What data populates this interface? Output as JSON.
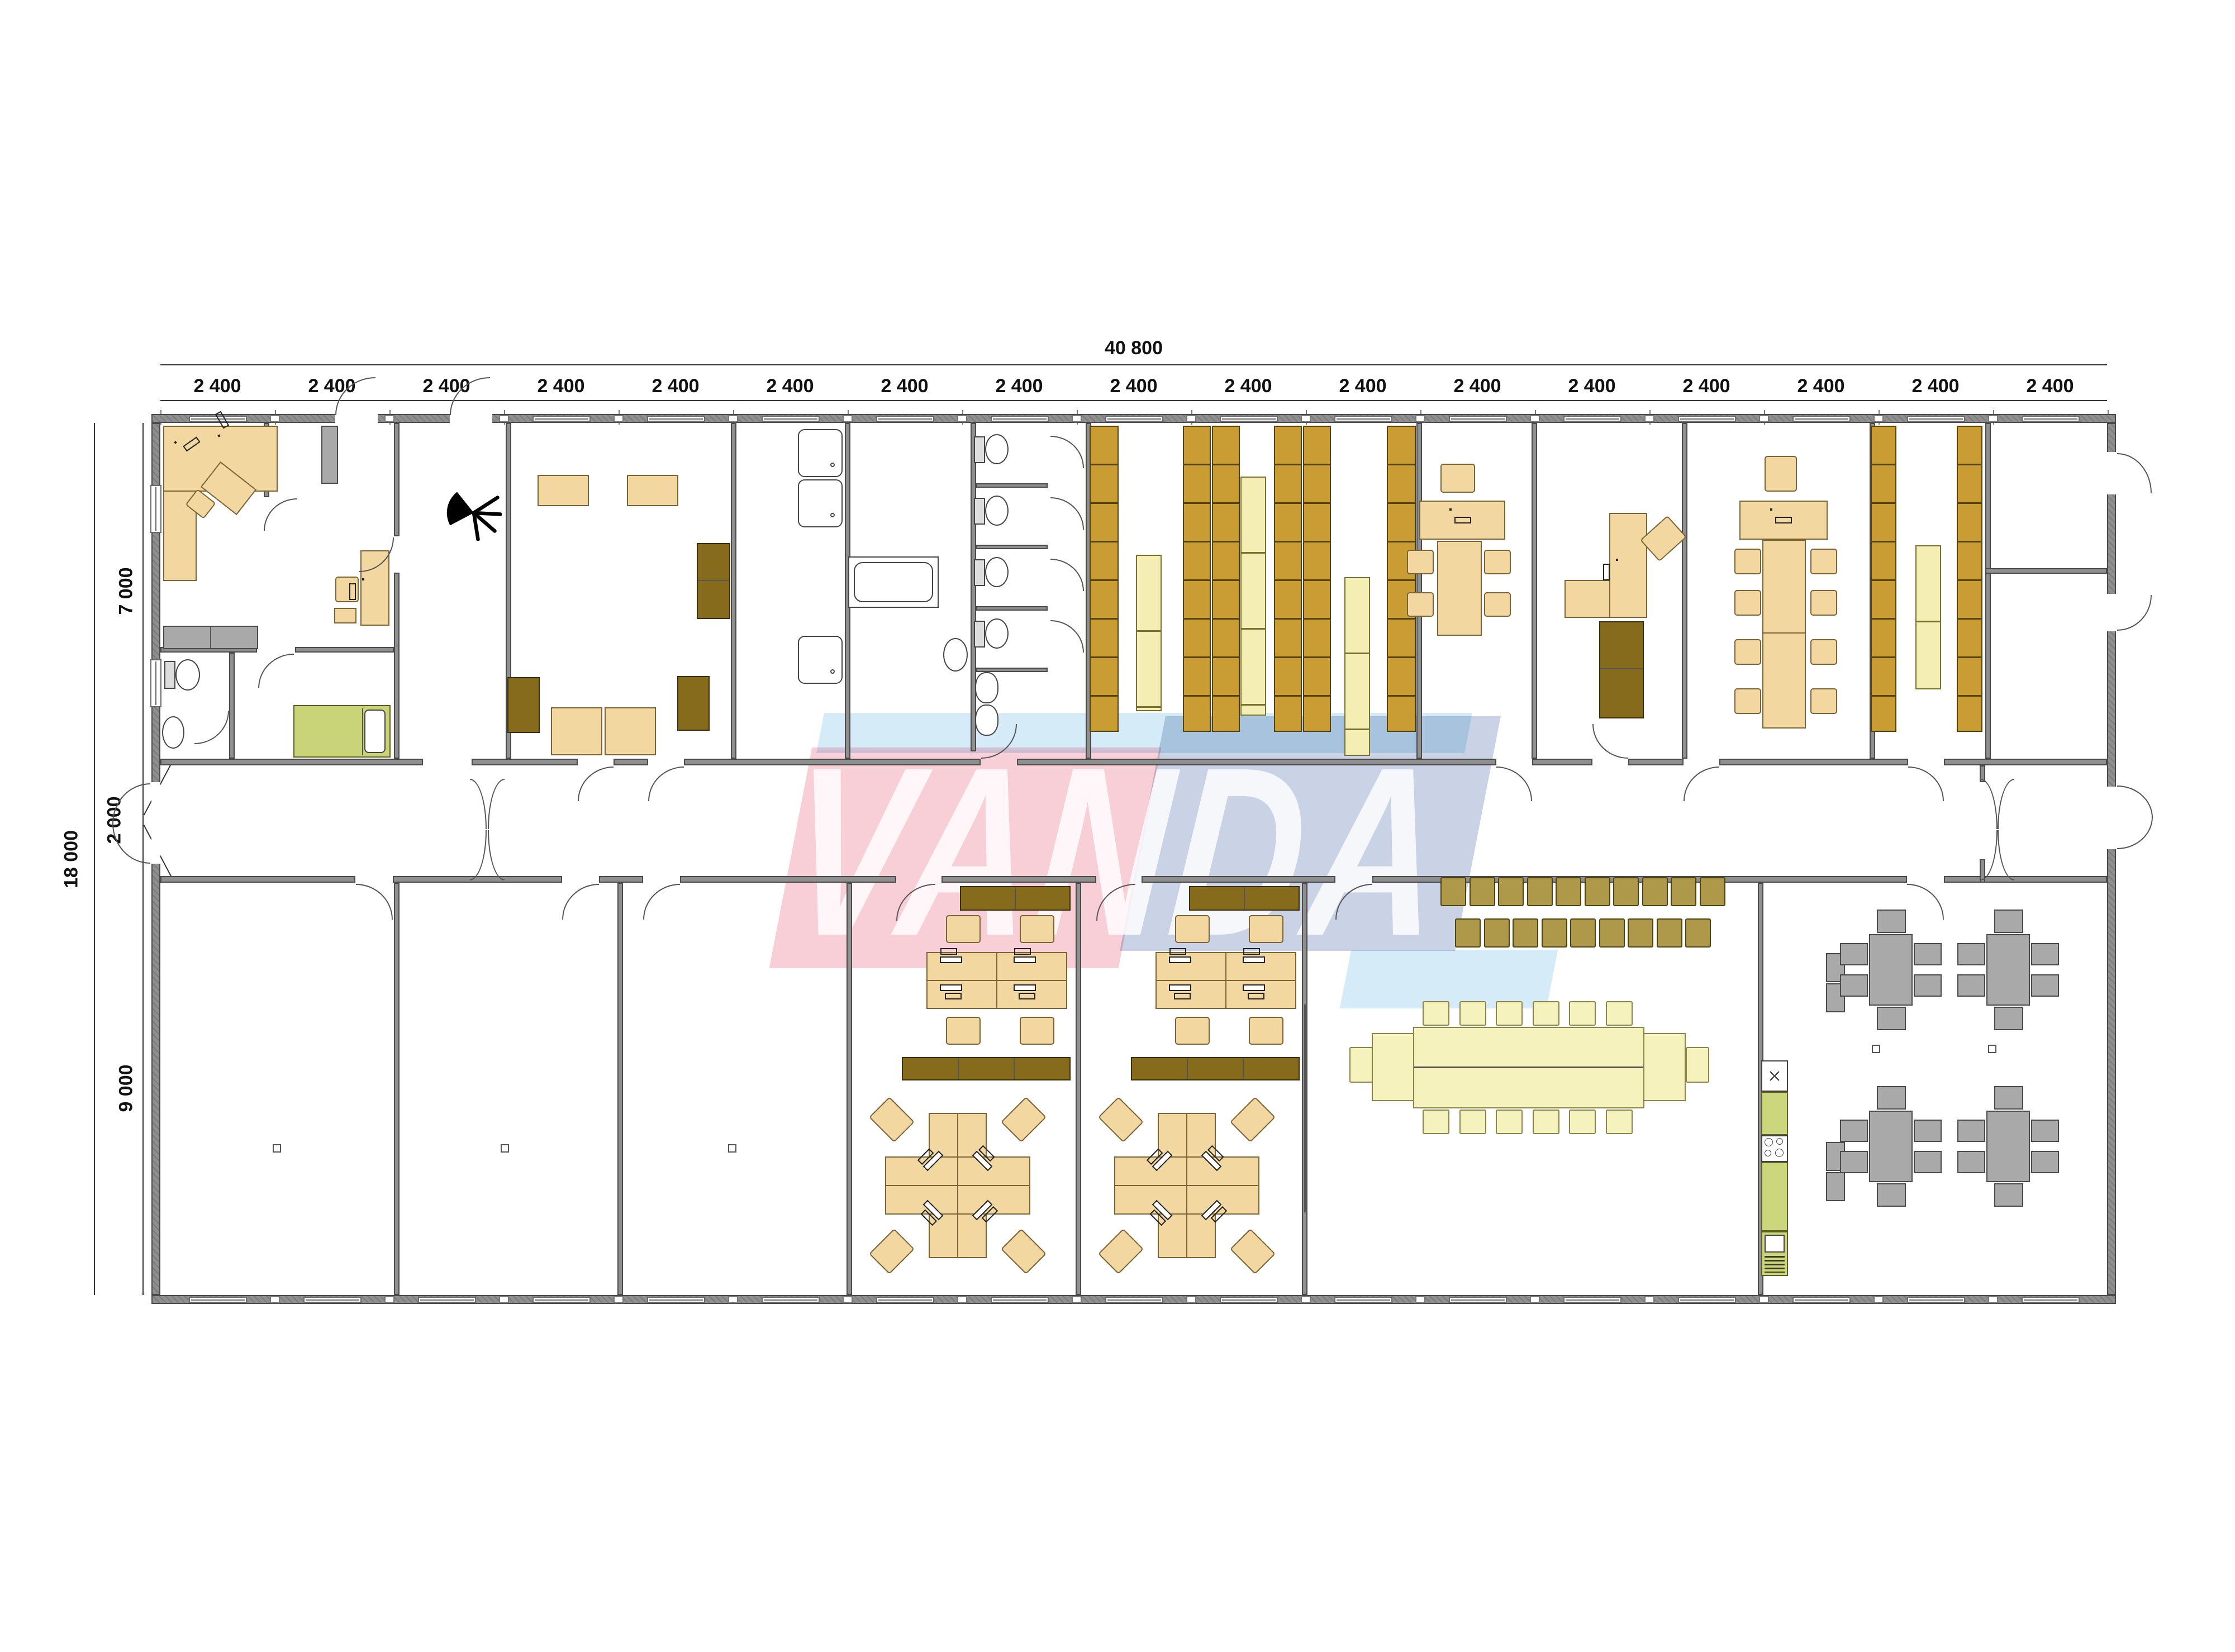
{
  "watermark": {
    "text": "VANDA"
  },
  "dimensions": {
    "top_total": "40 800",
    "module_label": "2 400",
    "module_count": 17,
    "left_total": "18 000",
    "left_segments": [
      "7 000",
      "2 000",
      "9 000"
    ]
  },
  "plan": {
    "counts": {
      "banquet_stool_rows": [
        10,
        9
      ],
      "banquet_side_chairs": 6,
      "meeting_side_chairs": 4,
      "dining_tables": 4,
      "dining_chairs_per_table": 6,
      "toilet_stalls": 4,
      "shower_stalls": 3,
      "empty_rooms": 3,
      "workstation_rooms": 2,
      "top_wall_windows": 15,
      "bottom_wall_windows": 17
    },
    "colors": {
      "wall": "#8f8f8f",
      "wall_edge": "#4a4a4a",
      "desk": "#f2d8a0",
      "shelf": "#c99d33",
      "cabinet": "#876b1d",
      "pale_rack": "#f4eeb4",
      "banquet_table": "#f6f2bd",
      "stool": "#ae9849",
      "bed_green": "#ccd67d",
      "kitchen_green": "#ccd67d",
      "gray_furniture": "#a9a9a9",
      "watermark_pink": "rgba(242,158,176,0.50)",
      "watermark_blue": "rgba(148,168,204,0.50)",
      "watermark_cyan": "rgba(178,220,242,0.55)"
    }
  }
}
